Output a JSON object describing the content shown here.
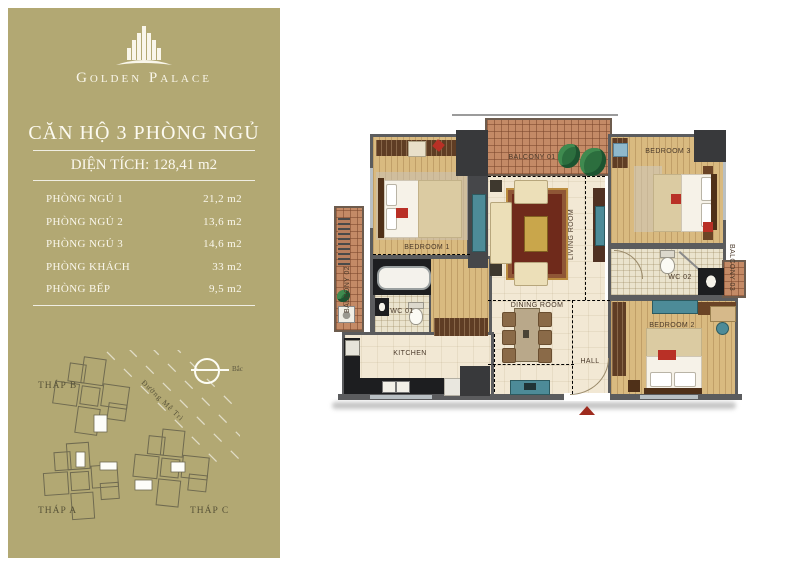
{
  "colors": {
    "panel_olive": "#b2a873",
    "balcony_terracotta": "#c48a66",
    "wood_floor": "#d9ba80",
    "marble_floor": "#f2e8d4",
    "wall_gray": "#5b5c5e",
    "accent_red": "#b93026",
    "furniture_teal": "#4d8b98",
    "rug_red": "#6f2a1b",
    "logo_white": "#f9f6ea"
  },
  "sidebar": {
    "brand": {
      "name": "Golden Palace"
    },
    "title": "CĂN HỘ 3 PHÒNG NGỦ",
    "area_line": "DIỆN TÍCH: 128,41 m2",
    "rooms": [
      {
        "label": "PHÒNG NGỦ 1",
        "value": "21,2 m2"
      },
      {
        "label": "PHÒNG NGỦ 2",
        "value": "13,6 m2"
      },
      {
        "label": "PHÒNG NGỦ 3",
        "value": "14,6 m2"
      },
      {
        "label": "PHÒNG KHÁCH",
        "value": "33 m2"
      },
      {
        "label": "PHÒNG BẾP",
        "value": "9,5 m2"
      }
    ],
    "compass_label": "Bắc",
    "site_plan": {
      "towers": [
        "THÁP B",
        "THÁP A",
        "THÁP C"
      ],
      "road": "Đường Mễ Trì"
    }
  },
  "floor_plan": {
    "rooms": {
      "bedroom1": "BEDROOM 1",
      "bedroom2": "BEDROOM 2",
      "bedroom3": "BEDROOM 3",
      "living": "LIVING ROOM",
      "dining": "DINING ROOM",
      "kitchen": "KITCHEN",
      "hall": "HALL",
      "wc1": "WC 01",
      "wc2": "WC 02",
      "balcony1": "BALCONY 01",
      "balcony2": "BALCONY 02",
      "balcony3": "BALCONY 03"
    }
  }
}
